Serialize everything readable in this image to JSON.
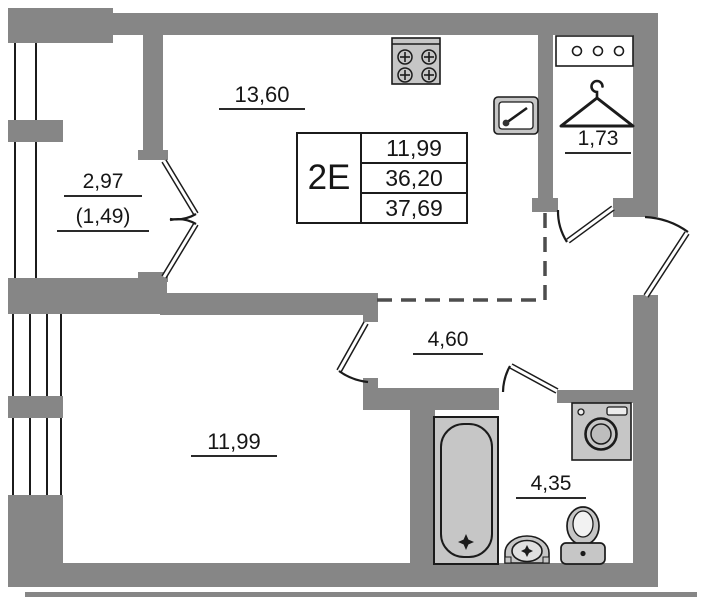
{
  "unit": {
    "type_label": "2Е",
    "living_area": "11,99",
    "total_area": "36,20",
    "overall_area": "37,69"
  },
  "rooms": {
    "kitchen_living": {
      "area": "13,60"
    },
    "balcony": {
      "area": "2,97",
      "reduced_area": "(1,49)"
    },
    "wardrobe": {
      "area": "1,73"
    },
    "hallway": {
      "area": "4,60"
    },
    "bedroom": {
      "area": "11,99"
    },
    "bathroom": {
      "area": "4,35"
    }
  },
  "icons": [
    "stove-icon",
    "kitchen-sink-icon",
    "shelf-hooks-icon",
    "hanger-icon",
    "bathtub-icon",
    "washing-machine-icon",
    "pedestal-sink-icon",
    "toilet-icon"
  ],
  "colors": {
    "wall": "#868686",
    "fixture": "#c6c6c6",
    "line": "#1b1b1b",
    "background": "#ffffff",
    "dash": "#4d4d4d"
  }
}
